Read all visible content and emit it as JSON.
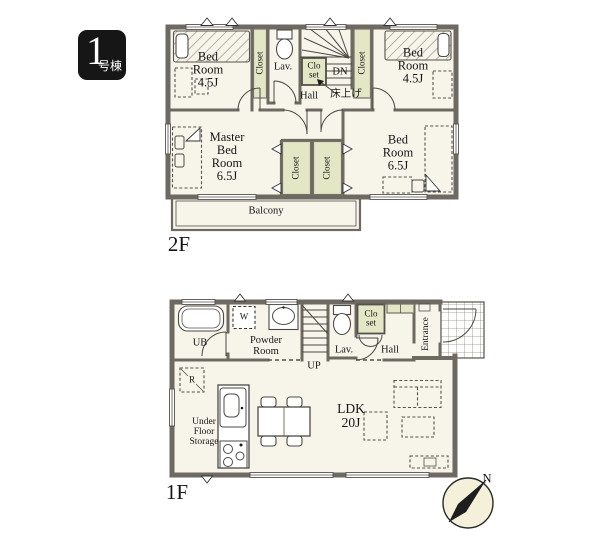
{
  "badge": {
    "number": "1",
    "suffix": "号棟"
  },
  "colors": {
    "wall": "#6e6a61",
    "floor": "#f7f4ea",
    "closet": "#e3e7c6",
    "badge": "#161616",
    "compass": "#f5f0da"
  },
  "floor2": {
    "title": "2F",
    "bedroom_small": "Bed\nRoom\n4.5J",
    "master_bedroom": "Master\nBed\nRoom\n6.5J",
    "bedroom_large": "Bed\nRoom\n6.5J",
    "closet": "Closet",
    "closet_small": "Clo\nset",
    "lav": "Lav.",
    "dn": "DN",
    "hall": "Hall",
    "hall_note": "床上げ",
    "balcony": "Balcony"
  },
  "floor1": {
    "title": "1F",
    "ub": "UB",
    "washer": "W",
    "powder_room": "Powder\nRoom",
    "up": "UP",
    "lav": "Lav.",
    "closet_small": "Clo\nset",
    "hall": "Hall",
    "entrance": "Entrance",
    "fridge": "R",
    "under_floor_storage": "Under\nFloor\nStorage",
    "ldk": "LDK\n20J",
    "north": "N"
  }
}
